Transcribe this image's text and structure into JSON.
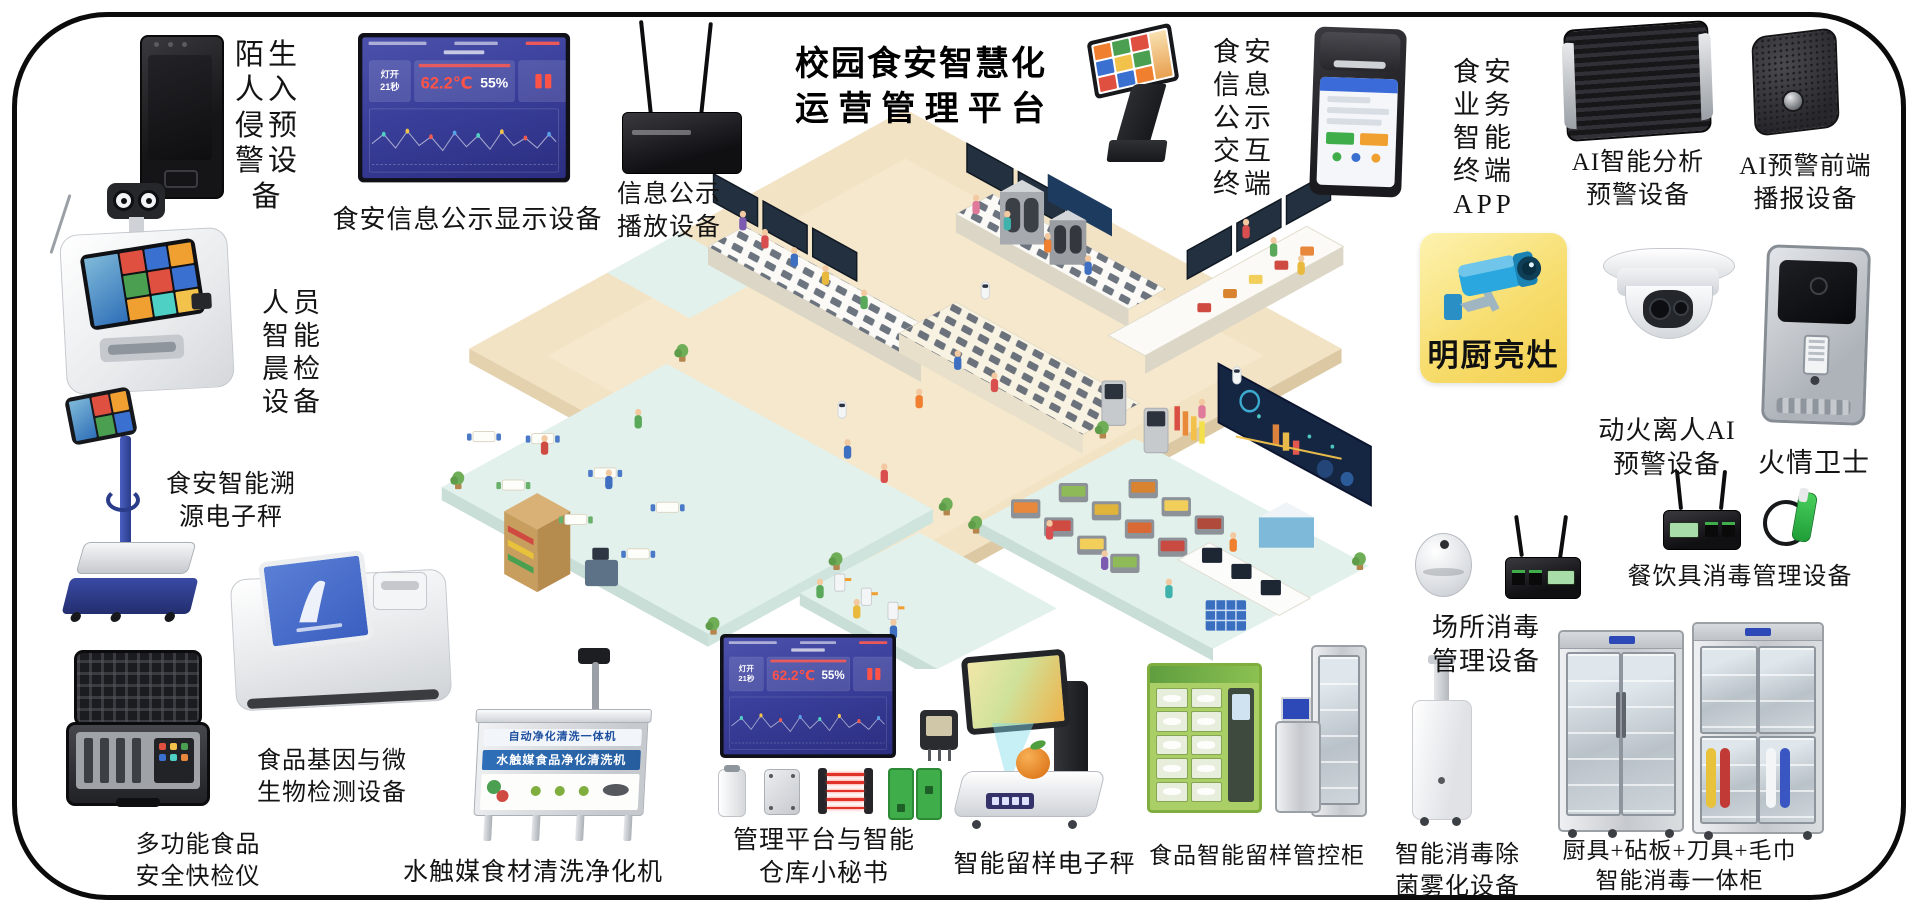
{
  "title": {
    "line1": "校园食安智慧化",
    "line2": "运营管理平台"
  },
  "dashboard_screen": {
    "status_card": "灯开\n21秒",
    "temperature": "62.2℃",
    "humidity": "55%"
  },
  "devices": {
    "stranger_alarm": {
      "label": "陌生\n人入\n侵预\n警设\n备"
    },
    "food_info_display": {
      "label": "食安信息公示显示设备"
    },
    "info_player": {
      "label": "信息公示\n播放设备"
    },
    "info_kiosk": {
      "label": "食安\n信息\n公示\n交互\n终端"
    },
    "app_terminal": {
      "label": "食安\n业务\n智能\n终端\nAPP"
    },
    "ai_analysis": {
      "label": "AI智能分析\n预警设备"
    },
    "ai_broadcast": {
      "label": "AI预警前端\n播报设备"
    },
    "bright_kitchen": {
      "label": "明厨亮灶"
    },
    "fire_ai_camera": {
      "label": "动火离人AI\n预警设备"
    },
    "fire_guardian": {
      "label": "火情卫士"
    },
    "tableware_disinfection": {
      "label": "餐饮具消毒管理设备"
    },
    "site_disinfection": {
      "label": "场所消毒\n管理设备"
    },
    "fog_sterilizer": {
      "label": "智能消毒除\n菌雾化设备"
    },
    "disinfection_cabinet": {
      "label": "厨具+砧板+刀具+毛巾\n智能消毒一体柜"
    },
    "sample_cabinet": {
      "label": "食品智能留样管控柜"
    },
    "sample_scale": {
      "label": "智能留样电子秤"
    },
    "mgmt_platform": {
      "label": "管理平台与智能\n仓库小秘书"
    },
    "food_washer": {
      "label": "水触媒食材清洗净化机",
      "banner_top": "自动净化清洗一体机",
      "banner_main": "水触媒食品净化清洗机"
    },
    "gene_detector": {
      "label": "食品基因与微\n生物检测设备"
    },
    "rapid_tester": {
      "label": "多功能食品\n安全快检仪"
    },
    "trace_scale": {
      "label": "食安智能溯\n源电子秤"
    },
    "morning_check": {
      "label": "人员\n智能\n晨检\n设备"
    }
  },
  "colors": {
    "bright_kitchen_bg": "#f7dd6e",
    "camera_blue": "#2aa7df",
    "dashboard_blue": "#3a3f9b",
    "alert_red": "#ff5347",
    "floor_beige": "#f2e3c5",
    "platform_teal": "#e2f1ec",
    "sample_cabinet_green": "#a9cf66"
  }
}
